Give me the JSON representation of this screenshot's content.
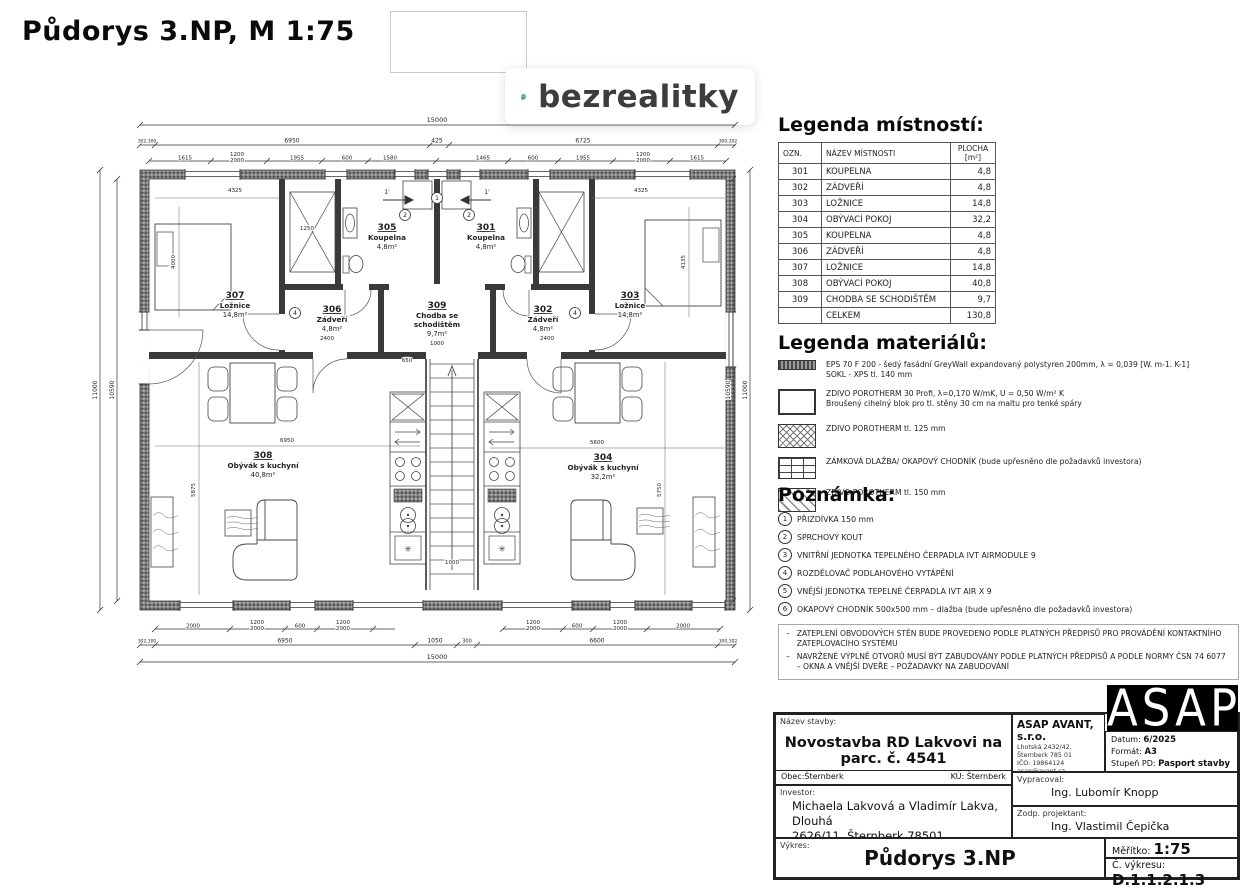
{
  "page": {
    "title": "Půdorys 3.NP, M 1:75"
  },
  "logo": {
    "text": "bezrealitky",
    "green": "#2f9e68"
  },
  "legend_rooms": {
    "title": "Legenda místností:",
    "headers": {
      "ozn": "OZN.",
      "name": "NÁZEV MÍSTNOSTI",
      "area": "PLOCHA [m²]"
    },
    "rows": [
      {
        "ozn": "301",
        "name": "KOUPELNA",
        "area": "4,8"
      },
      {
        "ozn": "302",
        "name": "ZÁDVEŘÍ",
        "area": "4,8"
      },
      {
        "ozn": "303",
        "name": "LOŽNICE",
        "area": "14,8"
      },
      {
        "ozn": "304",
        "name": "OBÝVACÍ POKOJ",
        "area": "32,2"
      },
      {
        "ozn": "305",
        "name": "KOUPELNA",
        "area": "4,8"
      },
      {
        "ozn": "306",
        "name": "ZÁDVEŘÍ",
        "area": "4,8"
      },
      {
        "ozn": "307",
        "name": "LOŽNICE",
        "area": "14,8"
      },
      {
        "ozn": "308",
        "name": "OBÝVACÍ POKOJ",
        "area": "40,8"
      },
      {
        "ozn": "309",
        "name": "CHODBA SE SCHODIŠTĚM",
        "area": "9,7"
      },
      {
        "ozn": "",
        "name": "CELKEM",
        "area": "130,8"
      }
    ]
  },
  "legend_materials": {
    "title": "Legenda materiálů:",
    "items": [
      {
        "swatch": "sw-eps",
        "text": "EPS 70 F 200 -  šedý fasádní GreyWall expandovaný polystyren 200mm, λ = 0,039 [W. m-1. K-1]\nSOKL - XPS tl. 140 mm"
      },
      {
        "swatch": "sw-p30",
        "text": "ZDIVO POROTHERM 30 Profi, λ=0,170 W/mK, U = 0,50 W/m² K\nBroušený cihelný blok pro tl. stěny 30 cm na maltu pro tenké spáry"
      },
      {
        "swatch": "sw-p125",
        "text": "ZDIVO POROTHERM  tl. 125 mm"
      },
      {
        "swatch": "sw-dlazba",
        "text": "ZÁMKOVÁ DLAŽBA/ OKAPOVÝ CHODNÍK (bude upřesněno dle požadavků investora)"
      },
      {
        "swatch": "sw-p150",
        "text": "ZDIVO POROTHERM tl. 150 mm"
      }
    ]
  },
  "notes": {
    "title": "Poznámka:",
    "items": [
      "PŘIZDÍVKA 150 mm",
      "SPRCHOVÝ KOUT",
      "VNITŘNÍ JEDNOTKA TEPELNÉHO ČERPADLA IVT AIRMODULE 9",
      "ROZDĚLOVAČ PODLAHOVÉHO VYTÁPĚNÍ",
      "VNĚJŠÍ JEDNOTKA TEPELNÉ ČERPADLA IVT AIR X 9",
      "OKAPOVÝ CHODNÍK 500x500 mm – dlažba (bude upřesněno dle požadavků investora)"
    ],
    "bullets": [
      "ZATEPLENÍ OBVODOVÝCH STĚN BUDE PROVEDENO PODLE PLATNÝCH PŘEDPISŮ PRO PROVÁDĚNÍ KONTAKTNÍHO ZATEPLOVACÍHO SYSTÉMU",
      "NAVRŽENÉ VÝPLNĚ OTVORŮ MUSÍ BÝT ZABUDOVÁNY PODLE PLATNÝCH PŘEDPISŮ A PODLE NORMY ČSN 74 6077 – OKNA A VNĚJŠÍ DVEŘE  – POŽADAVKY NA ZABUDOVÁNÍ"
    ]
  },
  "titleblock": {
    "nazev_label": "Název stavby:",
    "nazev": "Novostavba RD Lakvovi na parc. č. 4541",
    "obec": "Obec:Šternberk",
    "ku": "KÚ: Šternberk",
    "investor_label": "Investor:",
    "investor_l1": "Michaela Lakvová a Vladimír Lakva, Dlouhá",
    "investor_l2": "2626/11, Šternberk 78501",
    "vykres_label": "Výkres:",
    "vykres": "Půdorys 3.NP",
    "company": "ASAP AVANT, s.r.o.",
    "company_lines": [
      "Lhotská 2432/42, Šternberk 785 01",
      "IČO: 19864124",
      "asap@avant.cz",
      "+ 420 725 528 709"
    ],
    "datum_label": "Datum:",
    "datum": "6/2025",
    "format_label": "Formát:",
    "format": "A3",
    "stupen_label": "Stupeň PD:",
    "stupen": "Pasport stavby",
    "vypracoval_label": "Vypracoval:",
    "vypracoval": "Ing. Lubomír Knopp",
    "zodp_label": "Zodp. projektant:",
    "zodp": "Ing. Vlastimil Čepička",
    "meritko_label": "Měřítko:",
    "meritko": "1:75",
    "cislo_label": "Č. výkresu:",
    "cislo": "D.1.1.2.1.3",
    "logo": "ASAP"
  },
  "plan": {
    "rooms": [
      {
        "id": "307",
        "name": "Ložnice",
        "area": "14,8m²"
      },
      {
        "id": "306",
        "name": "Zádveří",
        "area": "4,8m²"
      },
      {
        "id": "305",
        "name": "Koupelna",
        "area": "4,8m²"
      },
      {
        "id": "309",
        "name": "Chodba se",
        "name2": "schodištěm",
        "area": "9,7m²"
      },
      {
        "id": "301",
        "name": "Koupelna",
        "area": "4,8m²"
      },
      {
        "id": "302",
        "name": "Zádveří",
        "area": "4,8m²"
      },
      {
        "id": "303",
        "name": "Ložnice",
        "area": "14,8m²"
      },
      {
        "id": "308",
        "name": "Obývák s kuchyní",
        "area": "40,8m²"
      },
      {
        "id": "304",
        "name": "Obývák s kuchyní",
        "area": "32,2m²"
      }
    ],
    "dims": {
      "top1": "15000",
      "top2": [
        "302,300",
        "6950",
        "425",
        "6725",
        "300,302"
      ],
      "top3": [
        "1615",
        "1200|2000",
        "1955",
        "600",
        "1580",
        "1465",
        "600",
        "1955",
        "1200|2000",
        "1615"
      ],
      "bot1": [
        "2000",
        "1200|2000",
        "600",
        "1200|2000",
        "1200|2000",
        "600",
        "1200|2000",
        "2000"
      ],
      "bot2": [
        "302,300",
        "6950",
        "1050",
        "300",
        "6600",
        "300,302"
      ],
      "bot3": "15000",
      "left": [
        "11000",
        "10590"
      ],
      "right": [
        "10590",
        "11000"
      ],
      "interior": [
        "4325",
        "4000",
        "1250",
        "4325",
        "4135",
        "650",
        "1000",
        "2400",
        "2400",
        "6950",
        "5600",
        "5875",
        "5750",
        "1000"
      ]
    },
    "markers": [
      "1",
      "2",
      "2",
      "4",
      "4"
    ],
    "arrow_label": "1'"
  }
}
